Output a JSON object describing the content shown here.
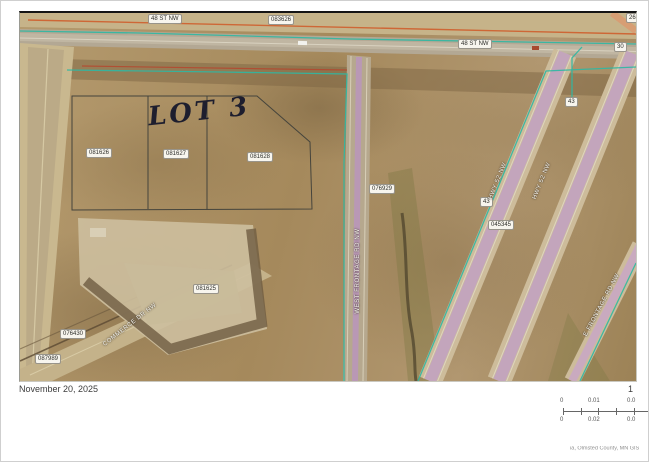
{
  "page": {
    "date": "November 20, 2025",
    "scale_ratio": "1",
    "attribution": "ia, Olmsted County, MN GIS"
  },
  "scalebar": {
    "miles_ticks": [
      "0",
      "0.01",
      "0.0"
    ],
    "km_ticks": [
      "0",
      "0.02",
      "0.0"
    ]
  },
  "map": {
    "annotation_lot": "LOT 3",
    "road_labels": {
      "top_street_left": "48 ST NW",
      "top_street_right": "48 ST NW",
      "sw_diagonal_street": "COMMERCE DR NW",
      "center_frontage_road": "WEST FRONTAGE RD NW",
      "highway_sb": "HWY 52 NW",
      "highway_nb": "HWY 52 NW",
      "east_frontage_road": "E FRONTAGE RD NW"
    },
    "route_markers": {
      "top_right_upper": "26",
      "top_right_lower": "30",
      "hwy_marker_west": "43",
      "hwy_marker_east": "43"
    },
    "parcels": {
      "north_road": "083626",
      "lot_west": "081626",
      "lot_center": "081627",
      "lot_east": "081628",
      "south_pad": "081625",
      "sw_road_parcel": "076430",
      "sw_corner": "087989",
      "frontage_east": "076929",
      "hwy_median": "045345"
    }
  },
  "colors": {
    "dirt_base": "#ab9065",
    "road_pavement": "#bfb39b",
    "highway_overlay": "#c2a2c2",
    "boundary_teal": "#2fb8a3",
    "boundary_orange": "#cf5f2e",
    "parcel_line": "#45443c",
    "label_bg": "#f7f5ee",
    "annotation_ink": "#1e1e2e"
  }
}
